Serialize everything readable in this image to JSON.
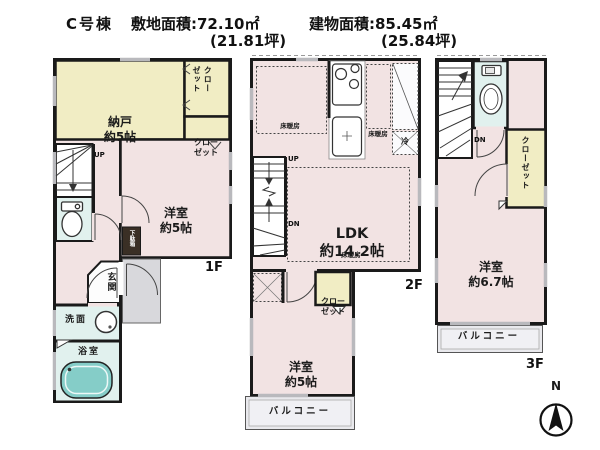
{
  "header": {
    "building": "C号棟",
    "land_area": "敷地面積:72.10㎡",
    "land_tsubo": "(21.81坪)",
    "building_area": "建物面積:85.45㎡",
    "building_tsubo": "(25.84坪)"
  },
  "floor1": {
    "label": "1F",
    "nando": "納戸",
    "nando_size": "約5帖",
    "closet_top_l1": "クロー",
    "closet_top_l2": "ゼット",
    "closet_l1": "クロー",
    "closet_l2": "ゼット",
    "bedroom": "洋室",
    "bedroom_size": "約5帖",
    "up": "UP",
    "shoe_cabinet": "下駄箱",
    "entrance": "玄関",
    "washroom": "洗面",
    "bathroom": "浴室"
  },
  "floor2": {
    "label": "2F",
    "heating1": "床暖房",
    "heating2": "床暖房",
    "heating3": "床暖房",
    "fridge": "冷",
    "ldk": "LDK",
    "ldk_size": "約14.2帖",
    "up": "UP",
    "down": "DN",
    "closet_l1": "クロー",
    "closet_l2": "ゼット",
    "bedroom": "洋室",
    "bedroom_size": "約5帖",
    "balcony": "バルコニー"
  },
  "floor3": {
    "label": "3F",
    "down": "DN",
    "closet": "クローゼット",
    "bedroom": "洋室",
    "bedroom_size": "約6.7帖",
    "balcony": "バルコニー"
  },
  "compass": {
    "north": "N"
  },
  "icons": {
    "compass": "north-arrow-in-circle",
    "toilet": "toilet-plan-symbol",
    "bathtub": "bathtub-plan-symbol",
    "basin": "round-washbasin",
    "stove": "three-burner-stove",
    "kitchen_sink": "kitchen-sink"
  },
  "colors": {
    "wall": "#1a1a1a",
    "room_pink": "#f2e3e3",
    "closet_yellow": "#f1edc4",
    "wet_area_cyan": "#e1f1ee",
    "bathtub_teal": "#85cdc8",
    "porch_gray": "#d8d8dc",
    "balcony_gray": "#e9e9ed",
    "shoe_cabinet_brown": "#3a2f25"
  }
}
